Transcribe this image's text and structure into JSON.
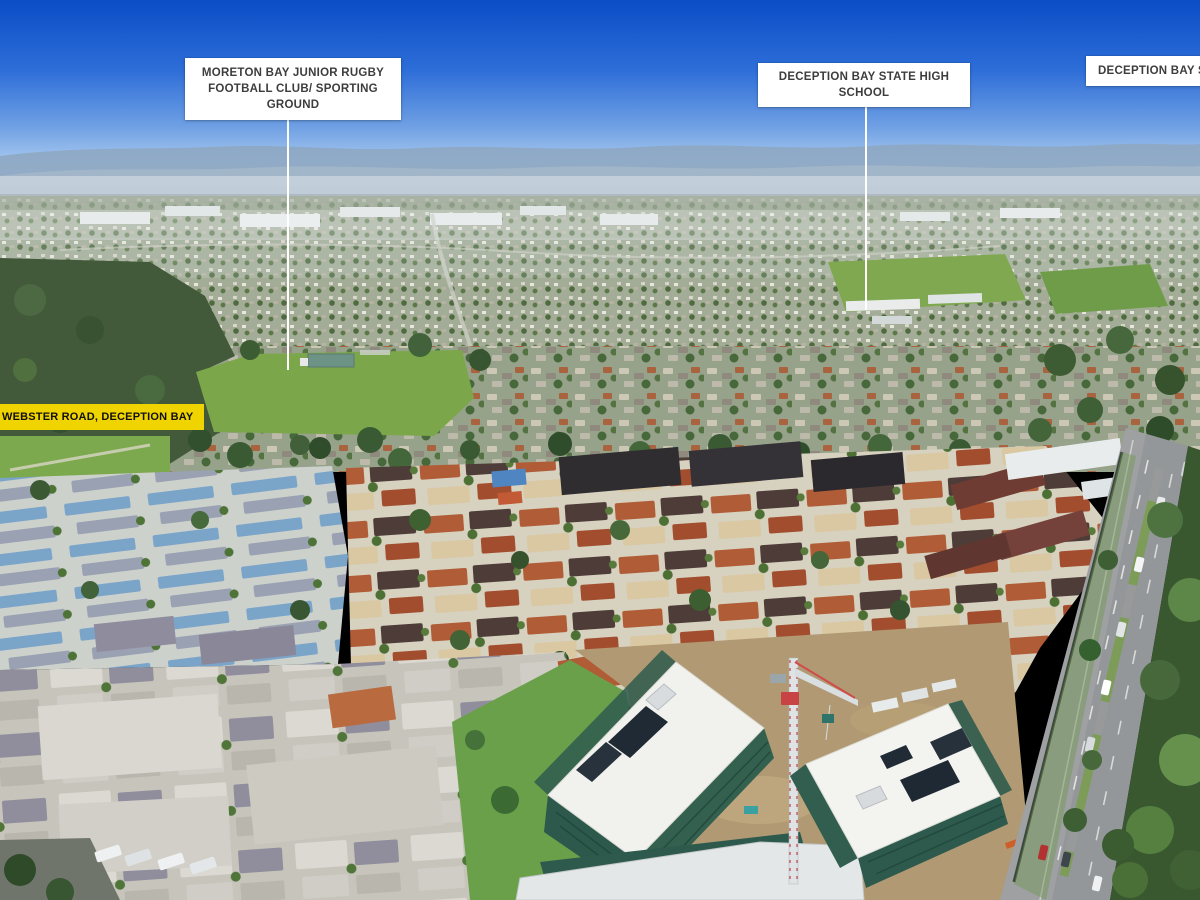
{
  "annotations": {
    "rugby": {
      "lines": [
        "MORETON BAY JUNIOR RUGBY",
        "FOOTBALL CLUB/ SPORTING GROUND"
      ],
      "box_color": "#ffffff",
      "text_color": "#3d3d3d"
    },
    "school": {
      "label": "DECEPTION BAY STATE HIGH SCHOOL",
      "box_color": "#ffffff",
      "text_color": "#3d3d3d"
    },
    "shops": {
      "label": "DECEPTION BAY SHOP",
      "box_color": "#ffffff",
      "text_color": "#3d3d3d"
    },
    "street": {
      "label": "WEBSTER ROAD, DECEPTION BAY",
      "box_color": "#f0d400",
      "text_color": "#101010"
    }
  },
  "scene": {
    "colors": {
      "sky_top": "#0a4dc6",
      "sky_horizon": "#cfe1f5",
      "mountains": "#8ea7c2",
      "field_green": "#7ba74a",
      "roof_terracotta": "#b05c36",
      "roof_dark_brown": "#4d3c37",
      "roof_cream": "#d9c8a2",
      "roof_blue": "#7ba4c9",
      "construction_mesh": "#2d5a4c",
      "construction_roof": "#f2f2ee",
      "dirt": "#b19a73",
      "road_asphalt": "#94979a",
      "crane_red": "#c84444",
      "car_red": "#b23131"
    }
  }
}
